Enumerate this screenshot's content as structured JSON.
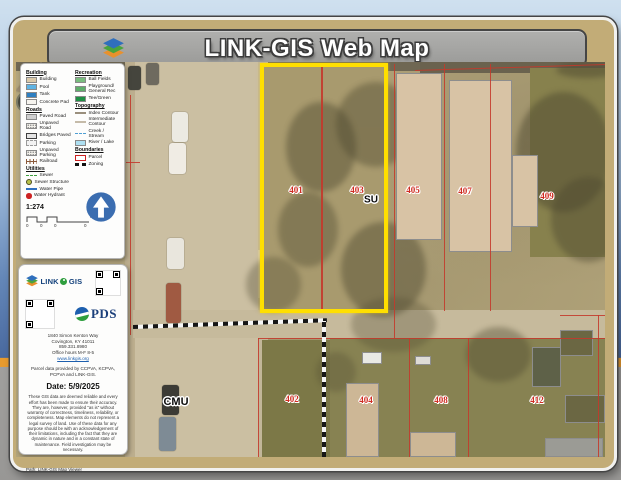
{
  "title_bar": {
    "title": "LINK-GIS Web Map"
  },
  "footer": {
    "path_label": "Path: LINK-GIS Map Viewer"
  },
  "colors": {
    "highlight_yellow": "#ffdf00",
    "parcel_line_red": "#c4392b",
    "label_red": "#cf2b20",
    "north_arrow_blue": "#3b6db0"
  },
  "legend": {
    "columns": [
      {
        "sections": [
          {
            "header": "Building",
            "items": [
              {
                "label": "Building",
                "swatch": "fill",
                "color": "#dbc9a8"
              },
              {
                "label": "Pool",
                "swatch": "fill",
                "color": "#5fb3e3"
              },
              {
                "label": "Tank",
                "swatch": "fill",
                "color": "#2e7fc1"
              },
              {
                "label": "Concrete Pad",
                "swatch": "fill",
                "color": "#f6f4ef"
              }
            ]
          },
          {
            "header": "Roads",
            "items": [
              {
                "label": "Paved Road",
                "swatch": "fill",
                "color": "#cfcfcf"
              },
              {
                "label": "Unpaved Road",
                "swatch": "dotted"
              },
              {
                "label": "Bridges Paved",
                "swatch": "thick-outline"
              },
              {
                "label": "Parking",
                "swatch": "dashed-outline"
              },
              {
                "label": "Unpaved Parking",
                "swatch": "dotted"
              },
              {
                "label": "Railroad",
                "swatch": "railroad",
                "color": "#8a5a3b"
              }
            ]
          },
          {
            "header": "Utilities",
            "items": [
              {
                "label": "Sewer",
                "swatch": "dashed-line",
                "color": "#3f9f3f"
              },
              {
                "label": "Sewer Structure",
                "swatch": "circle",
                "color": "#b8c24a"
              },
              {
                "label": "Water Pipe",
                "swatch": "line",
                "color": "#2e6fc0"
              },
              {
                "label": "Water Hydrant",
                "swatch": "dot",
                "color": "#cc2222"
              }
            ]
          }
        ]
      },
      {
        "sections": [
          {
            "header": "Recreation",
            "items": [
              {
                "label": "Ball Fields",
                "swatch": "fill",
                "color": "#79bd7e"
              },
              {
                "label": "Playground/ General Rec",
                "swatch": "fill",
                "color": "#5fae6b"
              },
              {
                "label": "Tee/Green",
                "swatch": "fill",
                "color": "#1f8f44"
              }
            ]
          },
          {
            "header": "Topography",
            "items": [
              {
                "label": "Index Contour",
                "swatch": "line",
                "color": "#9a8f7d"
              },
              {
                "label": "Intermediate Contour",
                "swatch": "line",
                "color": "#c5bba9"
              },
              {
                "label": "Creek / Stream",
                "swatch": "dashdot-line",
                "color": "#4f9fd4"
              },
              {
                "label": "River / Lake",
                "swatch": "fill",
                "color": "#aee0f2"
              }
            ]
          },
          {
            "header": "Boundaries",
            "items": [
              {
                "label": "Parcel",
                "swatch": "parcel-outline",
                "color": "#cc2222"
              },
              {
                "label": "Zoning",
                "swatch": "zoning-dash"
              }
            ]
          }
        ]
      }
    ],
    "scale": {
      "ratio": "1:274",
      "unit": "mi",
      "ticks": [
        "0",
        "0",
        "0",
        "0"
      ]
    }
  },
  "info_panel": {
    "brand": {
      "word1": "LINK",
      "word2": "GIS"
    },
    "pds": "PDS",
    "address_lines": [
      "1840 Simon Kenton Way",
      "Covington, KY 41011",
      "859.331.8980",
      "Office hours M-F 8-5"
    ],
    "website": "www.linkgis.org",
    "credit": "Parcel data provided by CCPVA, KCPVA, PCPVA and LINK-GIS.",
    "date": "Date: 5/9/2025",
    "disclaimer": "These GIS data are deemed reliable and every effort has been made to ensure their accuracy. They are, however, provided \"as is\" without warranty of correctness, timeliness, reliability, or completeness. Map elements do not represent a legal survey of land. Use of these data for any purpose should be with an acknowledgement of their limitations, including the fact that they are dynamic in nature and in a constant state of maintenance. Field investigation may be necessary."
  },
  "map": {
    "parcel_labels": [
      {
        "text": "401",
        "x": 296,
        "y": 190
      },
      {
        "text": "403",
        "x": 357,
        "y": 190
      },
      {
        "text": "405",
        "x": 413,
        "y": 190
      },
      {
        "text": "407",
        "x": 465,
        "y": 191
      },
      {
        "text": "409",
        "x": 547,
        "y": 196
      },
      {
        "text": "402",
        "x": 292,
        "y": 399
      },
      {
        "text": "404",
        "x": 366,
        "y": 400
      },
      {
        "text": "408",
        "x": 441,
        "y": 400
      },
      {
        "text": "412",
        "x": 537,
        "y": 400
      }
    ],
    "zoning_labels": [
      {
        "text": "SU",
        "x": 371,
        "y": 200
      },
      {
        "text": "CMU",
        "x": 176,
        "y": 402
      }
    ]
  }
}
